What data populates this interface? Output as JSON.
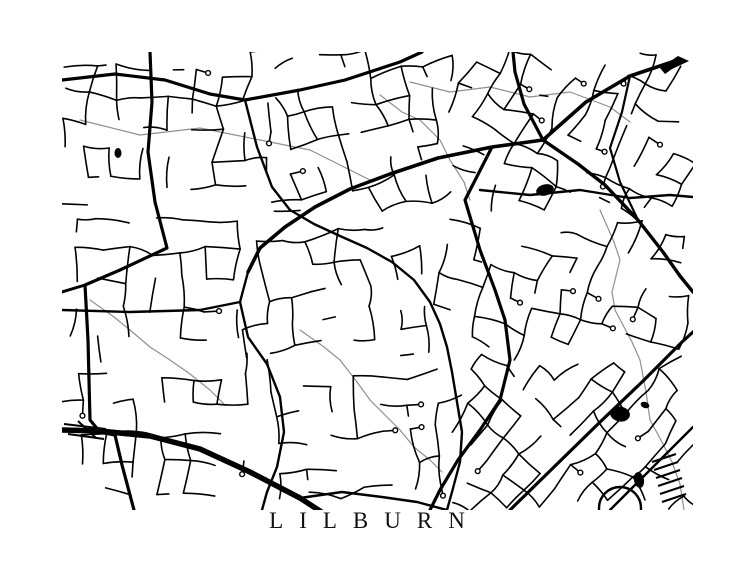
{
  "title": {
    "text": "LILBURN"
  },
  "map": {
    "background": "#ffffff",
    "road_color": "#000000",
    "stream_color": "#8f8f8f",
    "seed": 1337,
    "frame": {
      "left": 62,
      "top": 52,
      "width": 631,
      "height": 458
    },
    "roads": [
      {
        "w": 3.2,
        "pts": [
          [
            88,
            0
          ],
          [
            90,
            50
          ],
          [
            86,
            100
          ],
          [
            93,
            150
          ],
          [
            105,
            196
          ],
          [
            58,
            218
          ],
          [
            23,
            233
          ],
          [
            26,
            288
          ],
          [
            28,
            368
          ],
          [
            38,
            380
          ],
          [
            53,
            383
          ],
          [
            60,
            413
          ],
          [
            68,
            443
          ],
          [
            72,
            458
          ]
        ]
      },
      {
        "w": 3.0,
        "pts": [
          [
            23,
            233
          ],
          [
            0,
            240
          ]
        ]
      },
      {
        "w": 3.2,
        "pts": [
          [
            0,
            28
          ],
          [
            53,
            22
          ],
          [
            103,
            28
          ],
          [
            148,
            42
          ],
          [
            183,
            48
          ],
          [
            238,
            38
          ],
          [
            283,
            28
          ],
          [
            338,
            10
          ],
          [
            360,
            0
          ]
        ]
      },
      {
        "w": 5.5,
        "pts": [
          [
            0,
            378
          ],
          [
            38,
            379
          ],
          [
            88,
            384
          ],
          [
            138,
            397
          ],
          [
            188,
            420
          ],
          [
            238,
            446
          ],
          [
            278,
            472
          ]
        ]
      },
      {
        "w": 3.6,
        "pts": [
          [
            616,
            8
          ],
          [
            568,
            24
          ],
          [
            524,
            50
          ],
          [
            481,
            88
          ],
          [
            430,
            95
          ],
          [
            376,
            106
          ],
          [
            328,
            122
          ],
          [
            288,
            137
          ],
          [
            253,
            155
          ],
          [
            223,
            175
          ],
          [
            198,
            196
          ],
          [
            186,
            220
          ]
        ]
      },
      {
        "w": 3.2,
        "pts": [
          [
            481,
            88
          ],
          [
            462,
            52
          ],
          [
            453,
            20
          ],
          [
            451,
            0
          ]
        ]
      },
      {
        "w": 3.4,
        "pts": [
          [
            481,
            88
          ],
          [
            516,
            112
          ],
          [
            543,
            133
          ],
          [
            576,
            168
          ],
          [
            601,
            200
          ],
          [
            618,
            224
          ],
          [
            631,
            240
          ]
        ]
      },
      {
        "w": 3.2,
        "pts": [
          [
            430,
            95
          ],
          [
            403,
            148
          ],
          [
            418,
            198
          ],
          [
            433,
            238
          ],
          [
            443,
            268
          ],
          [
            448,
            308
          ],
          [
            438,
            348
          ],
          [
            418,
            378
          ],
          [
            396,
            408
          ],
          [
            378,
            438
          ],
          [
            368,
            458
          ]
        ]
      },
      {
        "w": 3.2,
        "pts": [
          [
            448,
            458
          ],
          [
            492,
            415
          ],
          [
            536,
            372
          ],
          [
            580,
            330
          ],
          [
            620,
            290
          ],
          [
            631,
            280
          ]
        ]
      },
      {
        "w": 2.4,
        "pts": [
          [
            548,
            458
          ],
          [
            586,
            420
          ],
          [
            622,
            384
          ],
          [
            631,
            375
          ]
        ]
      },
      {
        "w": 2.4,
        "pts": [
          [
            186,
            220
          ],
          [
            178,
            250
          ],
          [
            186,
            285
          ],
          [
            205,
            312
          ],
          [
            218,
            345
          ],
          [
            222,
            380
          ],
          [
            215,
            415
          ],
          [
            205,
            440
          ],
          [
            200,
            458
          ]
        ]
      },
      {
        "w": 2.4,
        "pts": [
          [
            0,
            258
          ],
          [
            68,
            260
          ],
          [
            138,
            258
          ],
          [
            178,
            250
          ]
        ]
      },
      {
        "w": 2.4,
        "pts": [
          [
            183,
            48
          ],
          [
            195,
            95
          ],
          [
            210,
            135
          ],
          [
            228,
            158
          ],
          [
            252,
            172
          ],
          [
            278,
            184
          ],
          [
            305,
            196
          ],
          [
            330,
            210
          ],
          [
            352,
            228
          ],
          [
            368,
            250
          ],
          [
            378,
            272
          ],
          [
            385,
            295
          ],
          [
            390,
            320
          ],
          [
            395,
            350
          ],
          [
            400,
            380
          ],
          [
            398,
            410
          ],
          [
            390,
            440
          ],
          [
            385,
            458
          ]
        ]
      },
      {
        "w": 2.4,
        "pts": [
          [
            418,
            138
          ],
          [
            468,
            143
          ],
          [
            518,
            138
          ],
          [
            568,
            146
          ],
          [
            608,
            143
          ],
          [
            631,
            145
          ]
        ]
      },
      {
        "w": 2.4,
        "pts": [
          [
            238,
            446
          ],
          [
            280,
            440
          ],
          [
            320,
            445
          ],
          [
            355,
            450
          ],
          [
            385,
            458
          ]
        ]
      },
      {
        "w": 2.2,
        "pts": [
          [
            568,
            24
          ],
          [
            560,
            60
          ],
          [
            548,
            96
          ],
          [
            558,
            130
          ],
          [
            576,
            168
          ]
        ]
      }
    ],
    "detail_lines": [
      {
        "w": 2.0,
        "pts": [
          [
            2,
            372
          ],
          [
            44,
            377
          ]
        ]
      },
      {
        "w": 2.0,
        "pts": [
          [
            2,
            377
          ],
          [
            46,
            382
          ]
        ]
      },
      {
        "w": 2.0,
        "pts": [
          [
            6,
            382
          ],
          [
            42,
            387
          ]
        ]
      },
      {
        "w": 2.0,
        "pts": [
          [
            16,
            369
          ],
          [
            34,
            386
          ]
        ]
      },
      {
        "w": 2.2,
        "pts": [
          [
            590,
            410
          ],
          [
            614,
            402
          ]
        ]
      },
      {
        "w": 2.2,
        "pts": [
          [
            592,
            418
          ],
          [
            616,
            410
          ]
        ]
      },
      {
        "w": 2.2,
        "pts": [
          [
            594,
            426
          ],
          [
            618,
            418
          ]
        ]
      },
      {
        "w": 2.2,
        "pts": [
          [
            596,
            434
          ],
          [
            620,
            426
          ]
        ]
      },
      {
        "w": 2.2,
        "pts": [
          [
            598,
            442
          ],
          [
            622,
            434
          ]
        ]
      },
      {
        "w": 2.2,
        "pts": [
          [
            600,
            450
          ],
          [
            624,
            442
          ]
        ]
      }
    ],
    "loop": {
      "cx": 558,
      "cy": 456,
      "r": 21
    },
    "streams": [
      [
        [
          18,
          68
        ],
        [
          78,
          83
        ],
        [
          138,
          76
        ],
        [
          198,
          88
        ],
        [
          248,
          98
        ],
        [
          288,
          118
        ],
        [
          308,
          128
        ]
      ],
      [
        [
          318,
          43
        ],
        [
          340,
          60
        ],
        [
          358,
          68
        ],
        [
          378,
          88
        ],
        [
          388,
          108
        ],
        [
          402,
          130
        ],
        [
          408,
          148
        ]
      ],
      [
        [
          538,
          158
        ],
        [
          552,
          190
        ],
        [
          558,
          208
        ],
        [
          550,
          240
        ],
        [
          553,
          258
        ],
        [
          570,
          290
        ],
        [
          578,
          308
        ],
        [
          584,
          340
        ],
        [
          588,
          368
        ]
      ],
      [
        [
          238,
          278
        ],
        [
          262,
          295
        ],
        [
          278,
          308
        ],
        [
          295,
          330
        ],
        [
          308,
          348
        ],
        [
          322,
          362
        ],
        [
          338,
          378
        ],
        [
          352,
          395
        ],
        [
          368,
          408
        ],
        [
          380,
          420
        ]
      ],
      [
        [
          28,
          248
        ],
        [
          52,
          265
        ],
        [
          68,
          278
        ],
        [
          88,
          295
        ],
        [
          108,
          308
        ],
        [
          128,
          322
        ],
        [
          148,
          338
        ],
        [
          162,
          352
        ]
      ],
      [
        [
          348,
          30
        ],
        [
          388,
          40
        ],
        [
          428,
          35
        ],
        [
          468,
          45
        ],
        [
          508,
          40
        ],
        [
          548,
          55
        ],
        [
          568,
          70
        ]
      ],
      [
        [
          588,
          368
        ],
        [
          600,
          390
        ],
        [
          610,
          410
        ],
        [
          618,
          432
        ],
        [
          622,
          458
        ]
      ]
    ],
    "ponds": [
      {
        "cx": 483,
        "cy": 138,
        "rx": 9,
        "ry": 5.5,
        "rot": -15
      },
      {
        "cx": 558,
        "cy": 362,
        "rx": 10,
        "ry": 7.5,
        "rot": 10
      },
      {
        "cx": 56,
        "cy": 101,
        "rx": 3.5,
        "ry": 5,
        "rot": 0
      },
      {
        "cx": 577,
        "cy": 428,
        "rx": 5,
        "ry": 8,
        "rot": -10
      },
      {
        "cx": 583,
        "cy": 353,
        "rx": 4.5,
        "ry": 3,
        "rot": 20
      }
    ],
    "lake_arrow": [
      [
        598,
        16
      ],
      [
        616,
        4
      ],
      [
        627,
        9
      ],
      [
        610,
        17
      ],
      [
        603,
        22
      ]
    ],
    "districts": [
      [
        0,
        0,
        210,
        150,
        4,
        26,
        28,
        0.6
      ],
      [
        210,
        0,
        180,
        160,
        -12,
        25,
        27,
        0.62
      ],
      [
        390,
        0,
        241,
        165,
        24,
        24,
        26,
        0.64
      ],
      [
        0,
        150,
        185,
        155,
        0,
        27,
        29,
        0.55
      ],
      [
        185,
        160,
        190,
        150,
        -8,
        26,
        27,
        0.6
      ],
      [
        375,
        165,
        256,
        140,
        18,
        25,
        27,
        0.62
      ],
      [
        0,
        305,
        200,
        153,
        2,
        27,
        29,
        0.58
      ],
      [
        200,
        310,
        195,
        148,
        -5,
        27,
        28,
        0.55
      ],
      [
        395,
        305,
        236,
        153,
        42,
        24,
        26,
        0.66
      ]
    ]
  }
}
